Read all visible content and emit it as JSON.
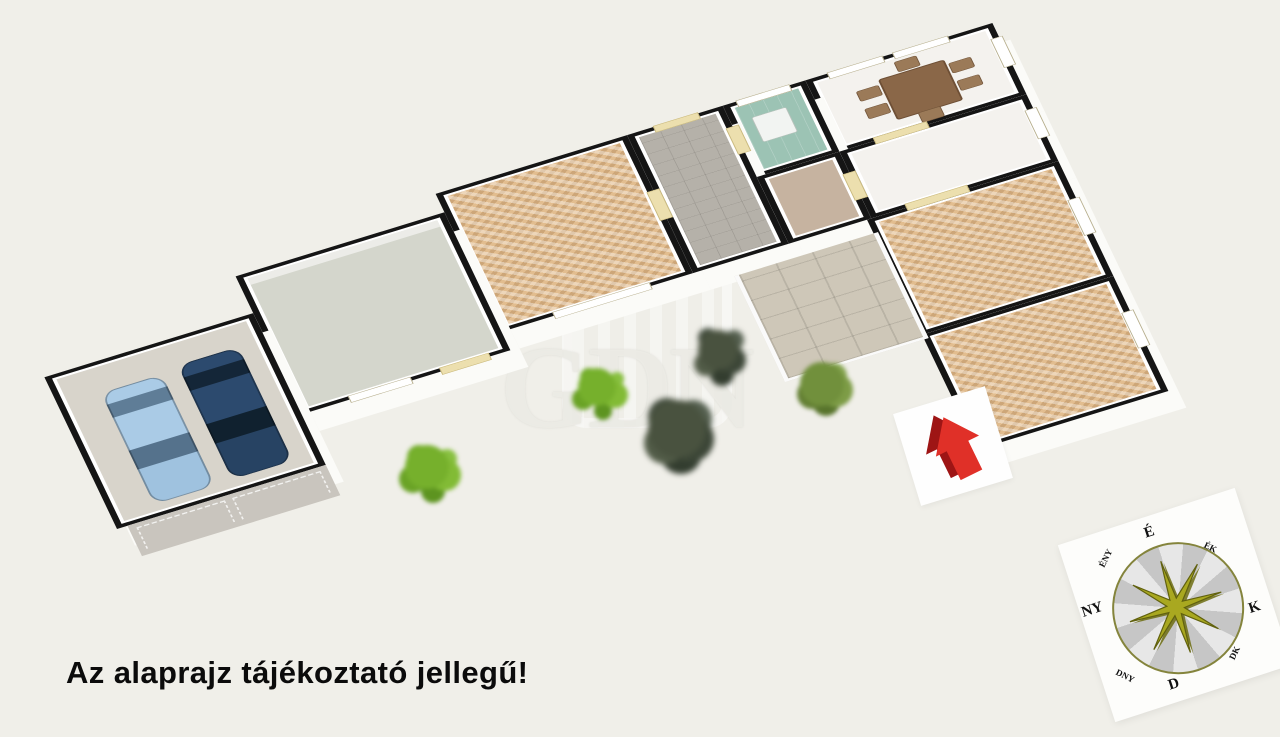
{
  "scene": {
    "type": "3d-floor-plan-render",
    "background_color": "#f0efe9",
    "caption": "Az alaprajz tájékoztató jellegű!",
    "watermark_text": "GDN"
  },
  "palette": {
    "wall": "#151515",
    "exterior_wall_face": "#fbfbf8",
    "parquet_floor": "#e2bd8f",
    "hallway_tile": "#b5b1a9",
    "storage_floor": "#d4d6cc",
    "garage_floor": "#d8d4cb",
    "driveway": "#c9c5be",
    "terrace_tile": "#cec7b8",
    "bathroom_floor": "#9cc3b4",
    "small_hall_floor": "#c6b3a0",
    "car_light_blue": "#aacbe6",
    "car_dark_navy": "#2c4a6e",
    "entrance_arrow_red": "#d92b20",
    "bush_green": "#76b02c",
    "conifer_green": "#49523f",
    "terrace_bush_green": "#71903c",
    "compass_star_olive": "#a9a820",
    "dining_table_brown": "#8a6748"
  },
  "rooms": [
    {
      "id": "garage",
      "floor_color": "#d8d4cb"
    },
    {
      "id": "storage",
      "floor_color": "#d4d6cc"
    },
    {
      "id": "living-room",
      "floor_color": "#e2bd8f"
    },
    {
      "id": "hallway",
      "floor_color": "#b5b1a9"
    },
    {
      "id": "bathroom",
      "floor_color": "#9cc3b4"
    },
    {
      "id": "small-hall",
      "floor_color": "#c6b3a0"
    },
    {
      "id": "dining-room",
      "floor_color": "#f4f2ee"
    },
    {
      "id": "kitchen",
      "floor_color": "#f4f2ee"
    },
    {
      "id": "bedroom-1",
      "floor_color": "#e2bd8f"
    },
    {
      "id": "bedroom-2",
      "floor_color": "#e2bd8f"
    },
    {
      "id": "terrace",
      "floor_color": "#cec7b8"
    }
  ],
  "vehicles": [
    {
      "id": "car-light-blue",
      "color": "#aacbe6"
    },
    {
      "id": "car-dark-navy",
      "color": "#2c4a6e"
    }
  ],
  "compass": {
    "labels": {
      "n": "É",
      "ne": "ÉK",
      "e": "K",
      "se": "DK",
      "s": "D",
      "sw": "DNY",
      "w": "NY",
      "nw": "ÉNY"
    }
  },
  "entrance_marker": {
    "shape": "red-arrow-up"
  }
}
